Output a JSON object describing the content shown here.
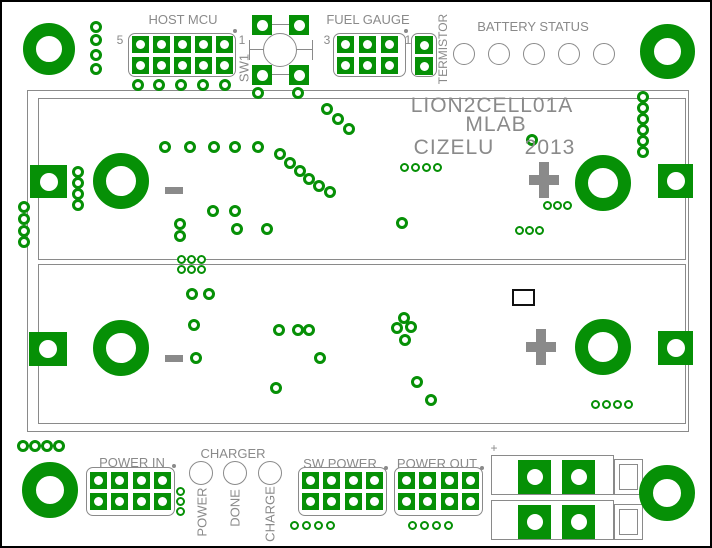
{
  "colors": {
    "copper_green": "#069006",
    "silkscreen_gray": "#8a8a8a",
    "outline_black": "#000000",
    "background_white": "#ffffff"
  },
  "board": {
    "title": "LION2CELL01A",
    "subtitle": "MLAB",
    "designer": "CIZELU",
    "year": "2013"
  },
  "top": {
    "host_mcu_label": "HOST MCU",
    "host_mcu_pin5": "5",
    "host_mcu_pin1": "1",
    "sw1_label": "SW1",
    "fuel_gauge_label": "FUEL GAUGE",
    "fuel_gauge_pin3": "3",
    "fuel_gauge_pin1": "1",
    "termistor_label": "TERMISTOR",
    "battery_status_label": "BATTERY STATUS"
  },
  "cells": {
    "cell1_minus": "-",
    "cell1_plus": "+",
    "cell2_minus": "-",
    "cell2_plus": "+"
  },
  "bottom": {
    "power_in_label": "POWER IN",
    "charger_label": "CHARGER",
    "led_power": "POWER",
    "led_done": "DONE",
    "led_charge": "CHARGE",
    "sw_power_label": "SW POWER",
    "power_out_label": "POWER OUT",
    "terminal_plus": "+"
  }
}
